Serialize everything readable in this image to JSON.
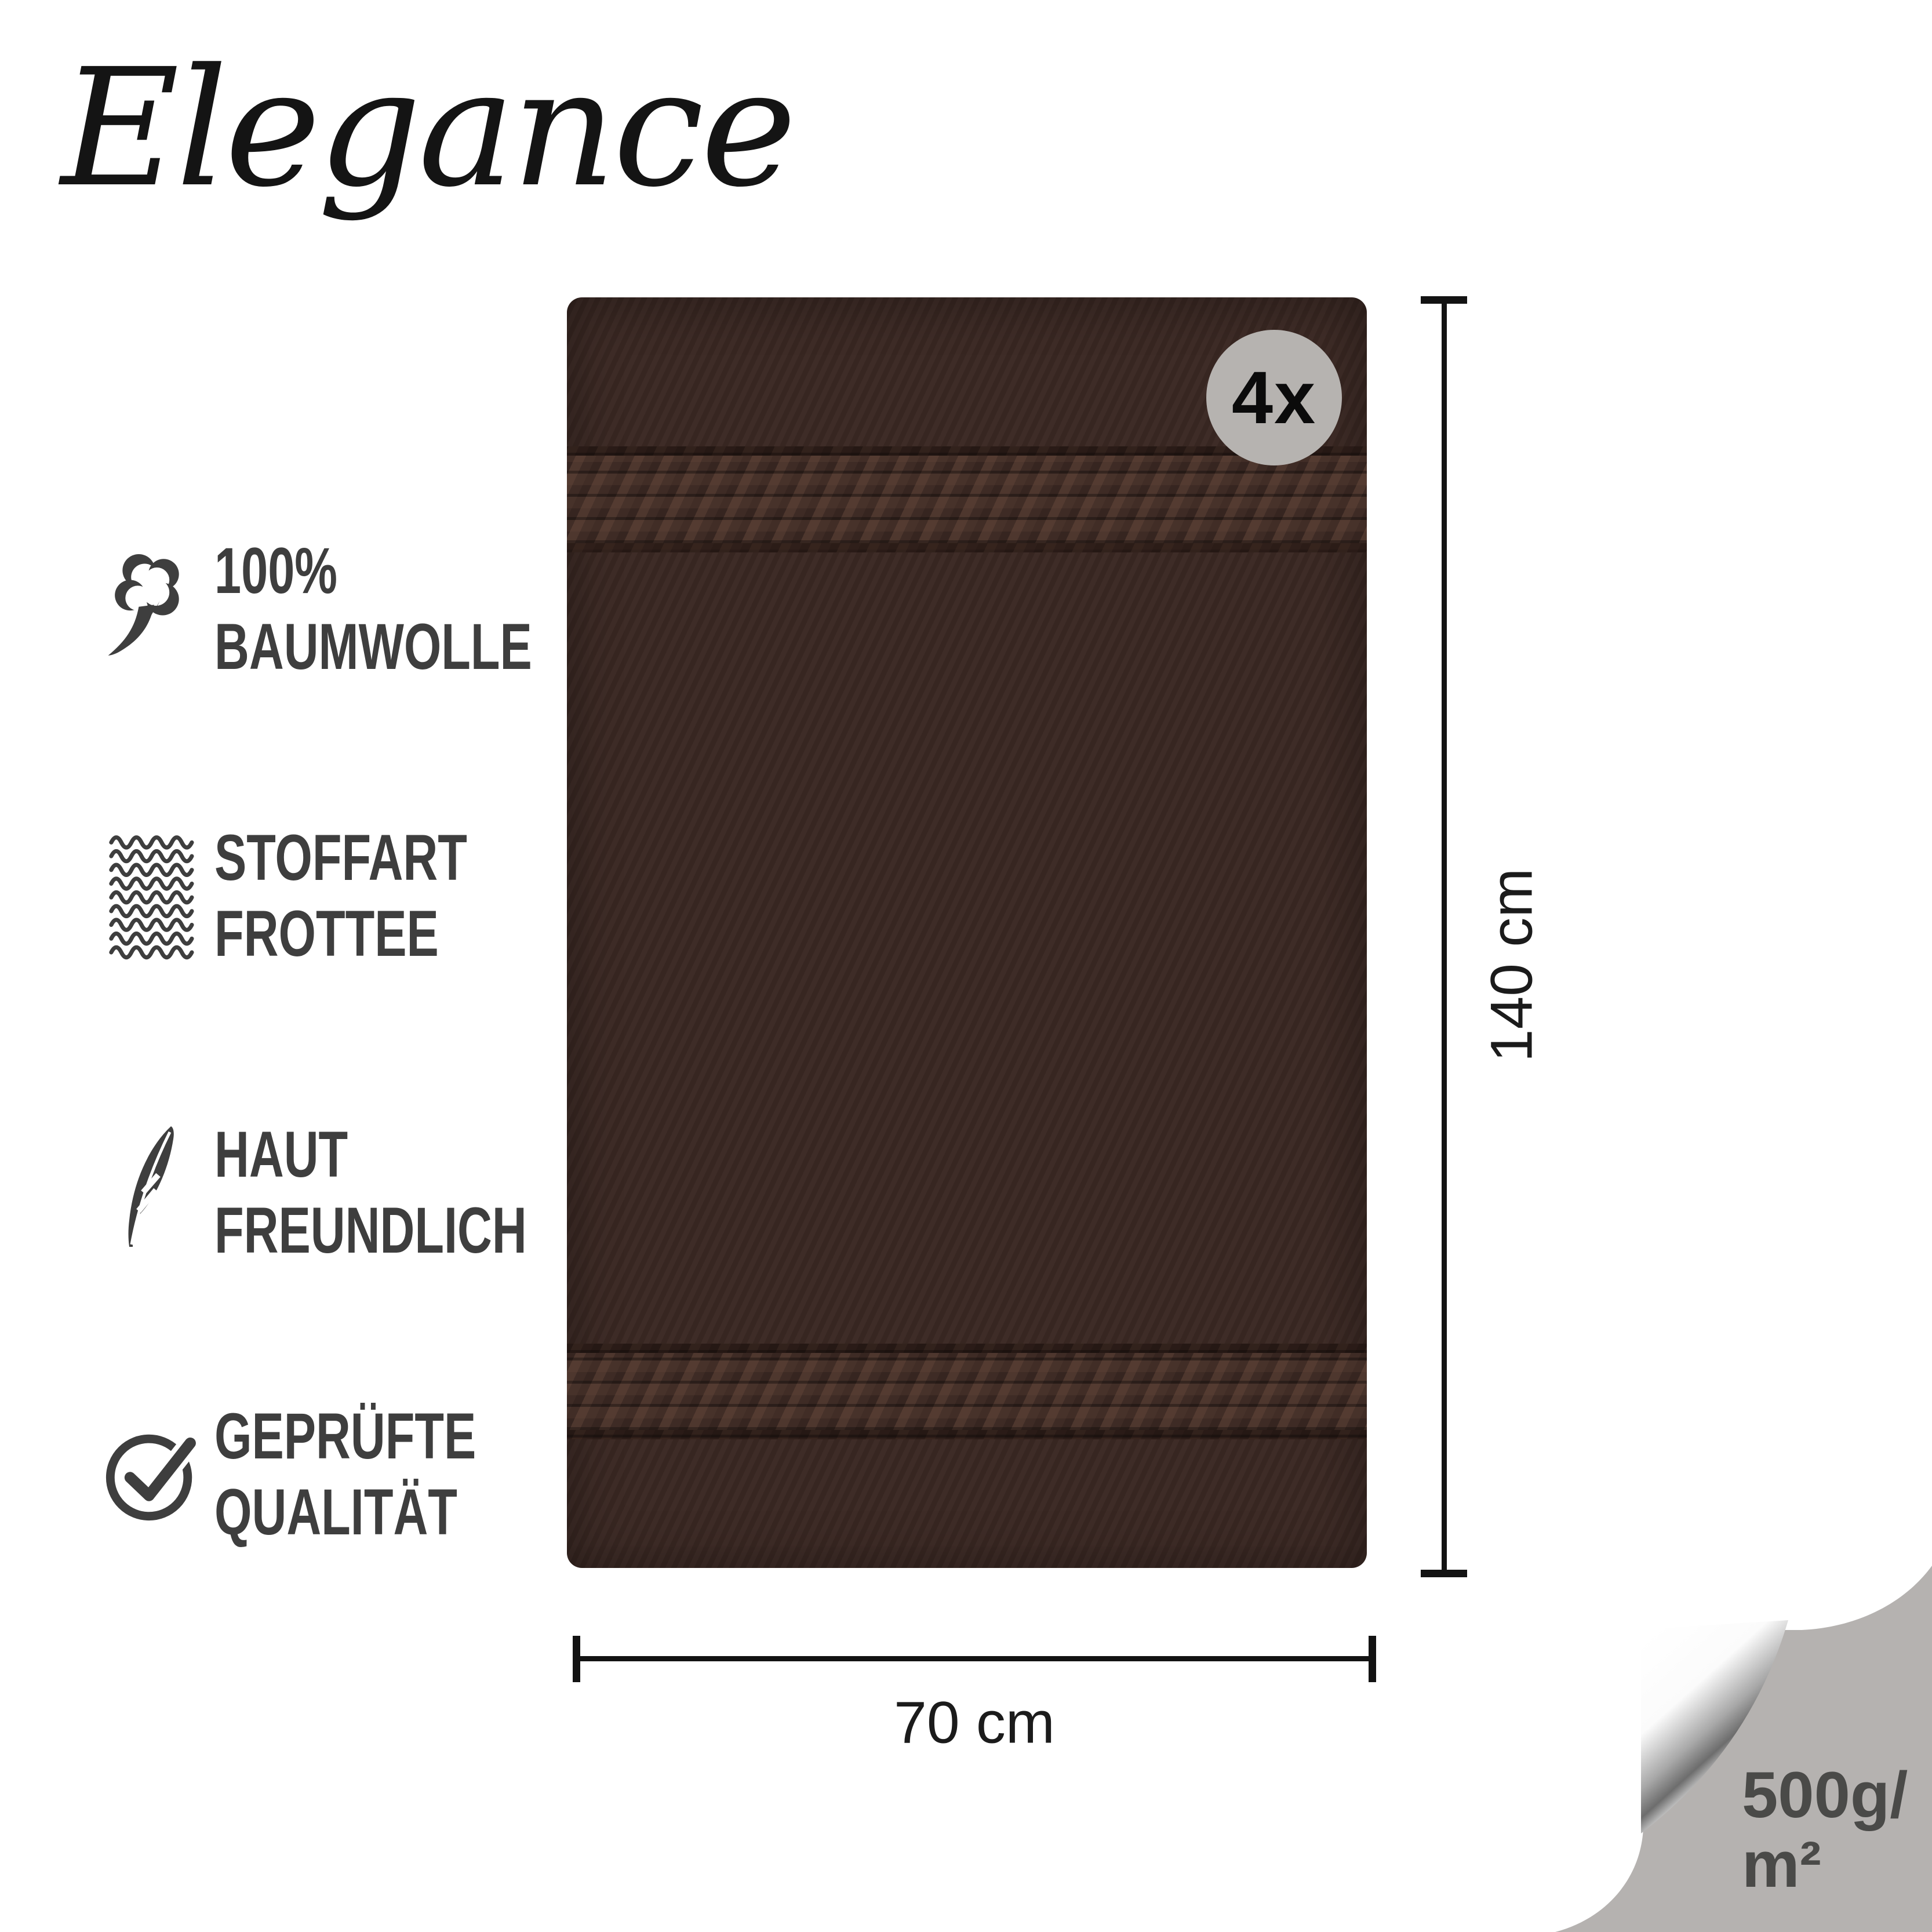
{
  "brand": {
    "logo_text": "Elegance"
  },
  "features": [
    {
      "icon": "cotton-icon",
      "lines": [
        "100%",
        "BAUMWOLLE"
      ]
    },
    {
      "icon": "fabric-texture-icon",
      "lines": [
        "STOFFART",
        "FROTTEE"
      ]
    },
    {
      "icon": "feather-icon",
      "lines": [
        "HAUT",
        "FREUNDLICH"
      ]
    },
    {
      "icon": "check-circle-icon",
      "lines": [
        "GEPRÜFTE",
        "QUALITÄT"
      ]
    }
  ],
  "product": {
    "quantity_badge": "4x",
    "height_label": "140 cm",
    "width_label": "70 cm",
    "weight_line1": "500g/",
    "weight_line2": "m²"
  },
  "colors": {
    "towel_body": "#3a2823",
    "towel_band": "#453029",
    "badge_bg": "#b6b3b0",
    "curl_gray": "#b5b2b0",
    "feature_text": "#3e3e3e",
    "dimension_ink": "#131313",
    "weight_text": "#4a4a48",
    "background": "#ffffff"
  }
}
